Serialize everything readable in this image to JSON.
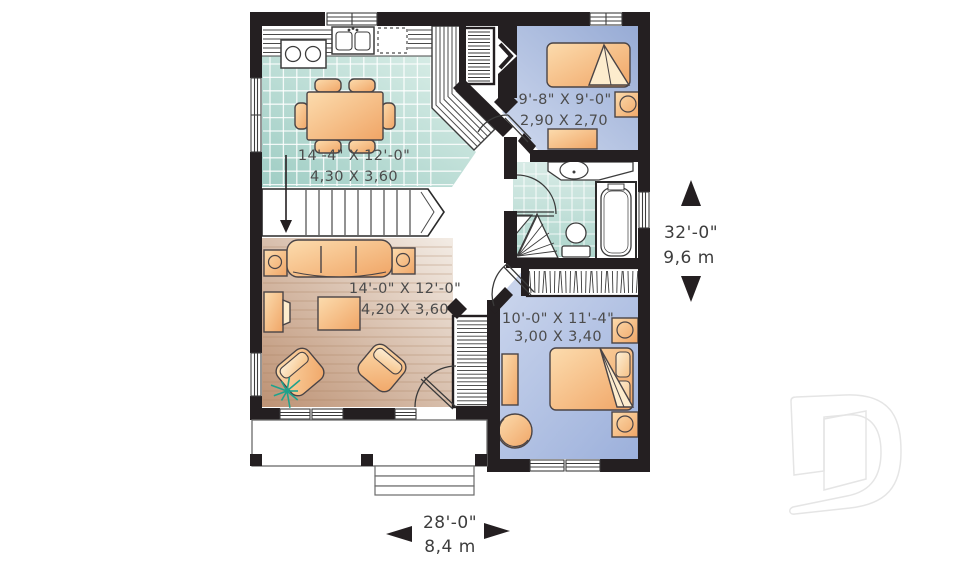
{
  "plan_labels": {
    "kitchen_dining": {
      "imperial": "14'-4\" X 12'-0\"",
      "metric": "4,30 X 3,60"
    },
    "living_room": {
      "imperial": "14'-0\" X 12'-0\"",
      "metric": "4,20 X 3,60"
    },
    "bedroom_1": {
      "imperial": "9'-8\" X 9'-0\"",
      "metric": "2,90 X 2,70"
    },
    "bedroom_2": {
      "imperial": "10'-0\" X 11'-4\"",
      "metric": "3,00 X 3,40"
    }
  },
  "overall_dimensions": {
    "depth": {
      "imperial": "32'-0\"",
      "metric": "9,6 m"
    },
    "width": {
      "imperial": "28'-0\"",
      "metric": "8,4 m"
    }
  },
  "icons": {
    "depth_arrows": [
      "arrow-up-icon",
      "arrow-down-icon"
    ],
    "width_arrows": [
      "arrow-left-icon",
      "arrow-right-icon"
    ],
    "entry_marker": "entry-chevron-icon",
    "stair_direction": "stair-down-arrow-icon"
  },
  "logo": {
    "letter": "D"
  },
  "colors": {
    "wall": "#241f21",
    "tile_floor": "#aed5cd",
    "wood_floor": "#c99e7e",
    "bedroom_floor": "#a9bbdf",
    "furniture": "#f5b97f",
    "plant": "#1fa28c",
    "label_text": "#4c4c4c",
    "logo_watermark": "#e6e6e6"
  }
}
